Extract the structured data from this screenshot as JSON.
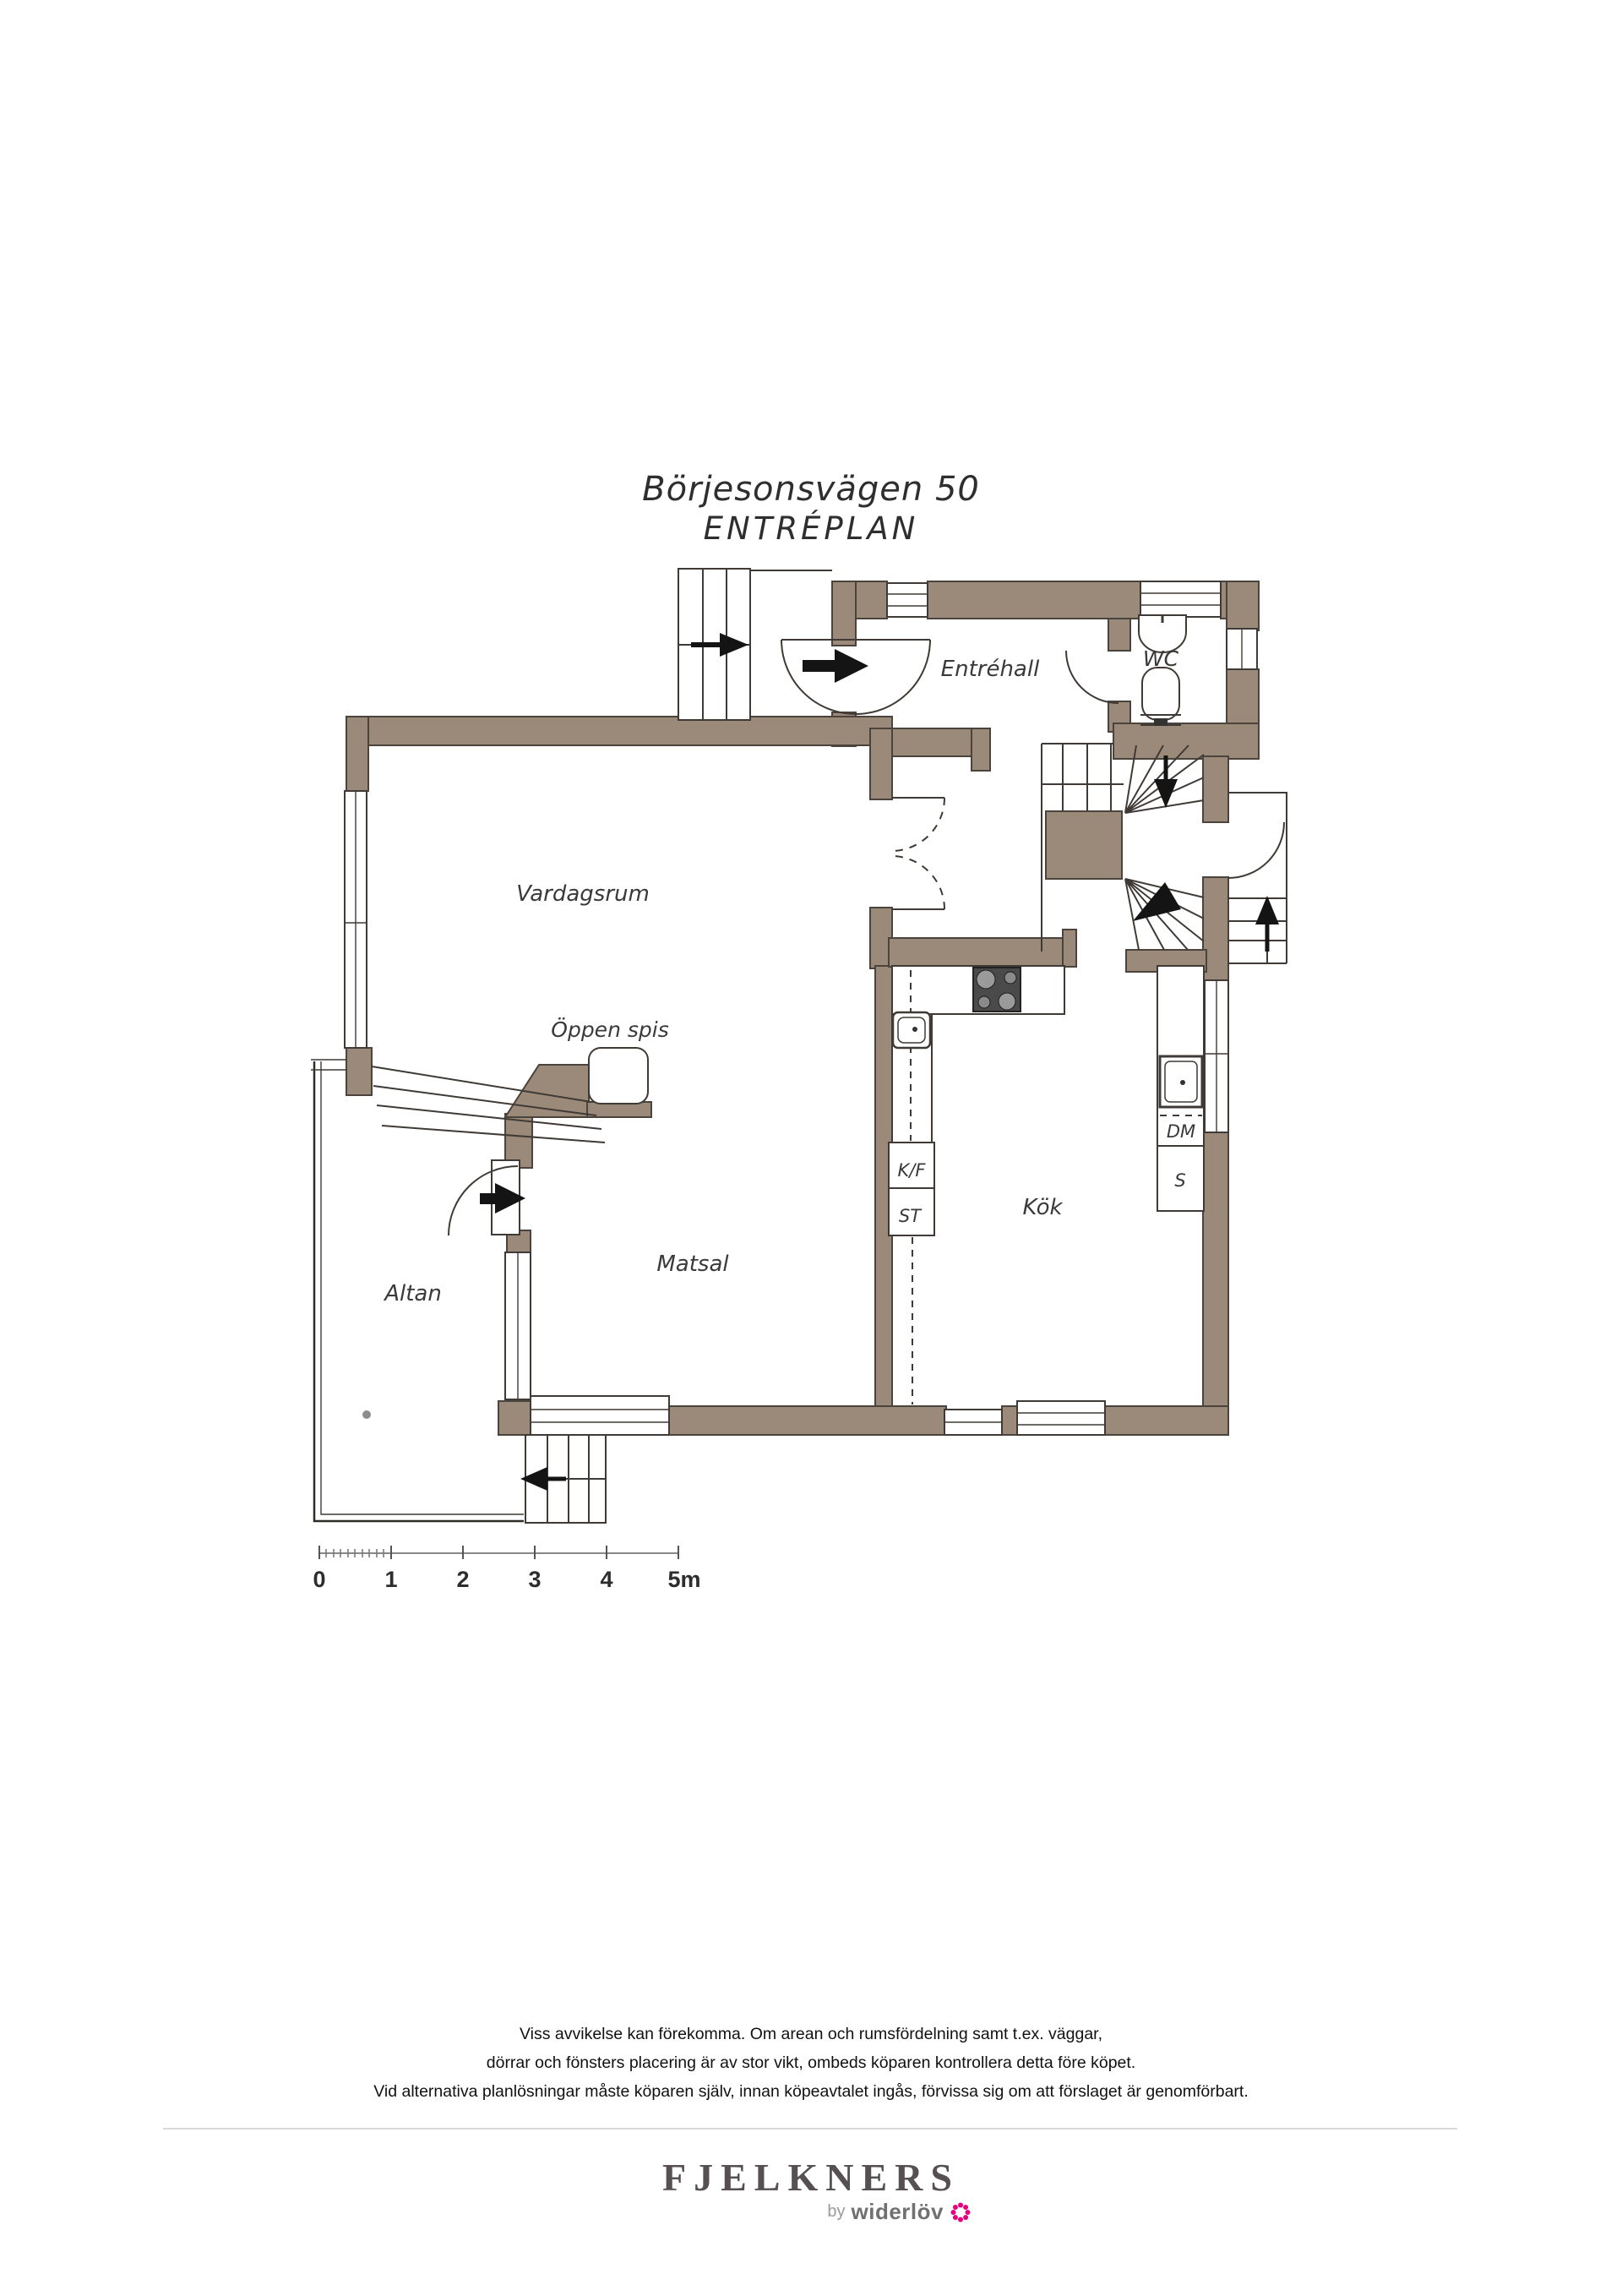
{
  "title": {
    "line1": "Börjesonsvägen 50",
    "line2": "ENTRÉPLAN"
  },
  "labels": {
    "entrehall": "Entréhall",
    "wc": "WC",
    "vardagsrum": "Vardagsrum",
    "oppen_spis": "Öppen spis",
    "altan": "Altan",
    "matsal": "Matsal",
    "kok": "Kök",
    "kf": "K/F",
    "st": "ST",
    "dm": "DM",
    "s": "S"
  },
  "scale_bar": {
    "labels": [
      "0",
      "1",
      "2",
      "3",
      "4",
      "5m"
    ]
  },
  "disclaimer": {
    "line1": "Viss avvikelse kan förekomma. Om arean och rumsfördelning samt t.ex. väggar,",
    "line2": "dörrar och fönsters placering är av stor vikt, ombeds köparen kontrollera detta före köpet.",
    "line3": "Vid alternativa planlösningar måste köparen själv, innan köpeavtalet ingås, förvissa sig om att förslaget är genomförbart."
  },
  "footer": {
    "brand": "FJELKNERS",
    "byline_prefix": "by",
    "byline_brand": "widerlöv"
  },
  "colors": {
    "wall": "#9b8a7a",
    "line": "#3f3a35",
    "accent_pink": "#e6007e"
  }
}
